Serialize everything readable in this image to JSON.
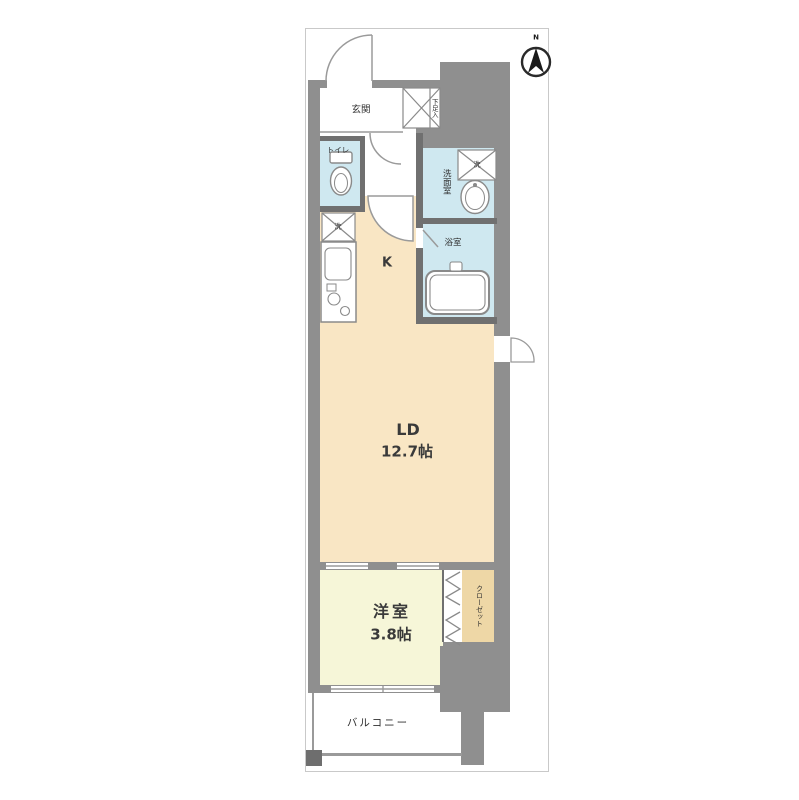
{
  "title": "apartment-floor-plan",
  "compass": {
    "north_label": "N"
  },
  "rooms": {
    "entrance": {
      "label": "玄関"
    },
    "shoe_cabinet": {
      "label": "下足入"
    },
    "toilet": {
      "label": "トイレ"
    },
    "washroom": {
      "label": "洗面室"
    },
    "bathroom": {
      "label": "浴室"
    },
    "kitchen": {
      "label": "K"
    },
    "living_dining": {
      "label": "LD",
      "size": "12.7帖"
    },
    "western_room": {
      "label": "洋室",
      "size": "3.8帖"
    },
    "closet": {
      "label": "クローゼット"
    },
    "balcony": {
      "label": "バルコニー"
    }
  },
  "fixtures": {
    "washer_symbol": "洗",
    "icons": [
      "toilet-icon",
      "sink-icon",
      "bathtub-icon",
      "kitchen-counter-icon",
      "washing-machine-icon",
      "shoe-cabinet-icon",
      "compass-north-icon",
      "folding-door-icon",
      "door-swing-arc",
      "sliding-window"
    ]
  },
  "colors": {
    "living_kitchen": "#f9e6c4",
    "western_room": "#f6f6d8",
    "wet_rooms": "#cfe8f0",
    "closet": "#eed7a6",
    "structure_gray": "#8f8f8f",
    "wall_gray": "#707070",
    "outline": "#8a8a8a"
  }
}
